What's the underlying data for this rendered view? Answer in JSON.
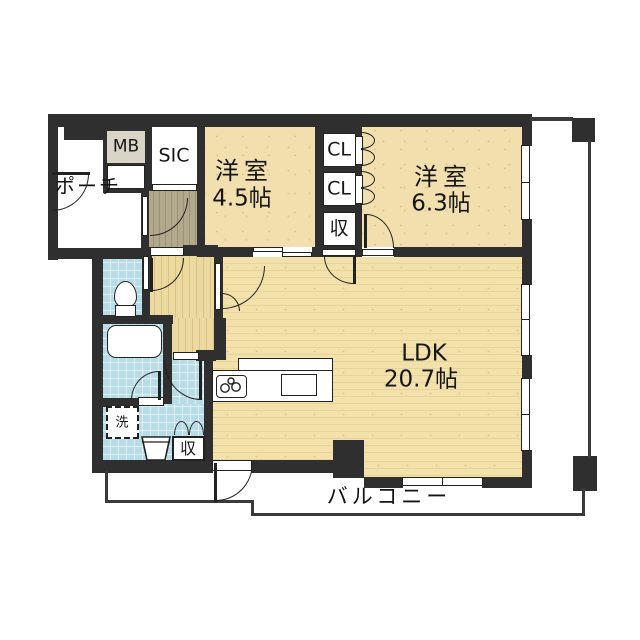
{
  "floorplan": {
    "rooms": [
      {
        "name": "洋室",
        "size": "4.5帖"
      },
      {
        "name": "洋室",
        "size": "6.3帖"
      },
      {
        "name": "LDK",
        "size": "20.7帖"
      }
    ],
    "spaces": {
      "porch": "ポーチ",
      "meter_box": "MB",
      "shoes_closet": "SIC",
      "closet1": "CL",
      "closet2": "CL",
      "hall_storage": "収",
      "washer": "洗",
      "wash_storage": "収",
      "balcony": "バルコニー"
    },
    "colors": {
      "wall": "#2f2f2f",
      "room_floor": "#f1e0ad",
      "hallway_floor": "#ecd9a0",
      "entry_floor": "#b2a98c",
      "wet_area": "#b8dce6",
      "meter_box_fill": "#d9d5c6",
      "background": "#ffffff"
    }
  }
}
